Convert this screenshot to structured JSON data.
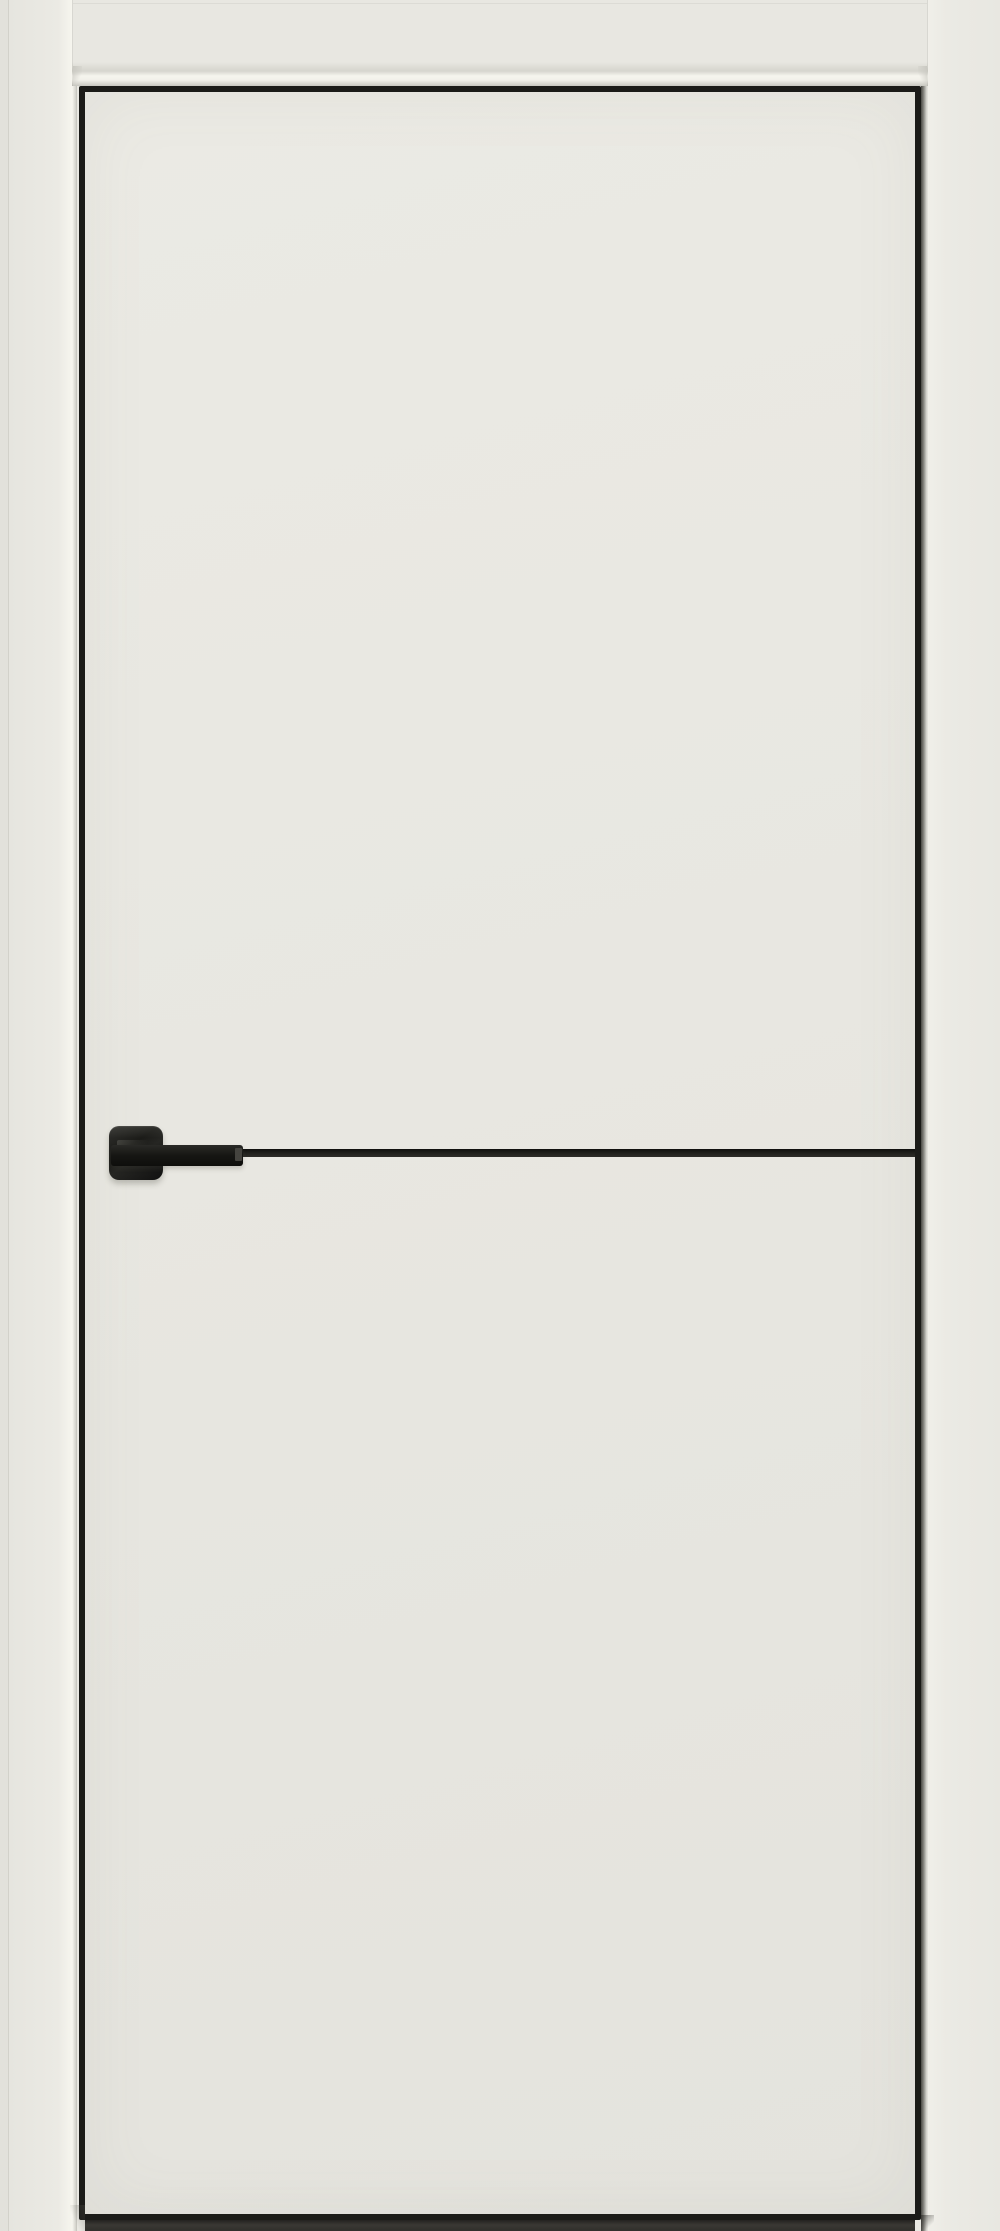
{
  "image": {
    "type": "product-photo",
    "subject": "white interior door, closed, front view",
    "features": [
      "ivory painted flush door leaf",
      "black aluminium edge trim around leaf",
      "black horizontal molding insert at handle height",
      "black square-rosette lever handle on left side",
      "ivory door casing on left, top and right",
      "dark floor gap shadow under the leaf",
      "no visible text"
    ],
    "colors": {
      "wall": "#e2e1db",
      "casing": "#e9e8e2",
      "casing_highlight": "#f5f4ed",
      "casing_chamfer_shadow": "#d6d5ce",
      "door_leaf": "#e8e7e1",
      "edge_trim_black": "#1b1b18",
      "molding_black": "#1d1d19",
      "handle_black": "#1a1a17",
      "handle_highlight": "#45443f",
      "reveal_shadow": "#4b4a45",
      "floor_gap_shadow": "#343330"
    }
  }
}
